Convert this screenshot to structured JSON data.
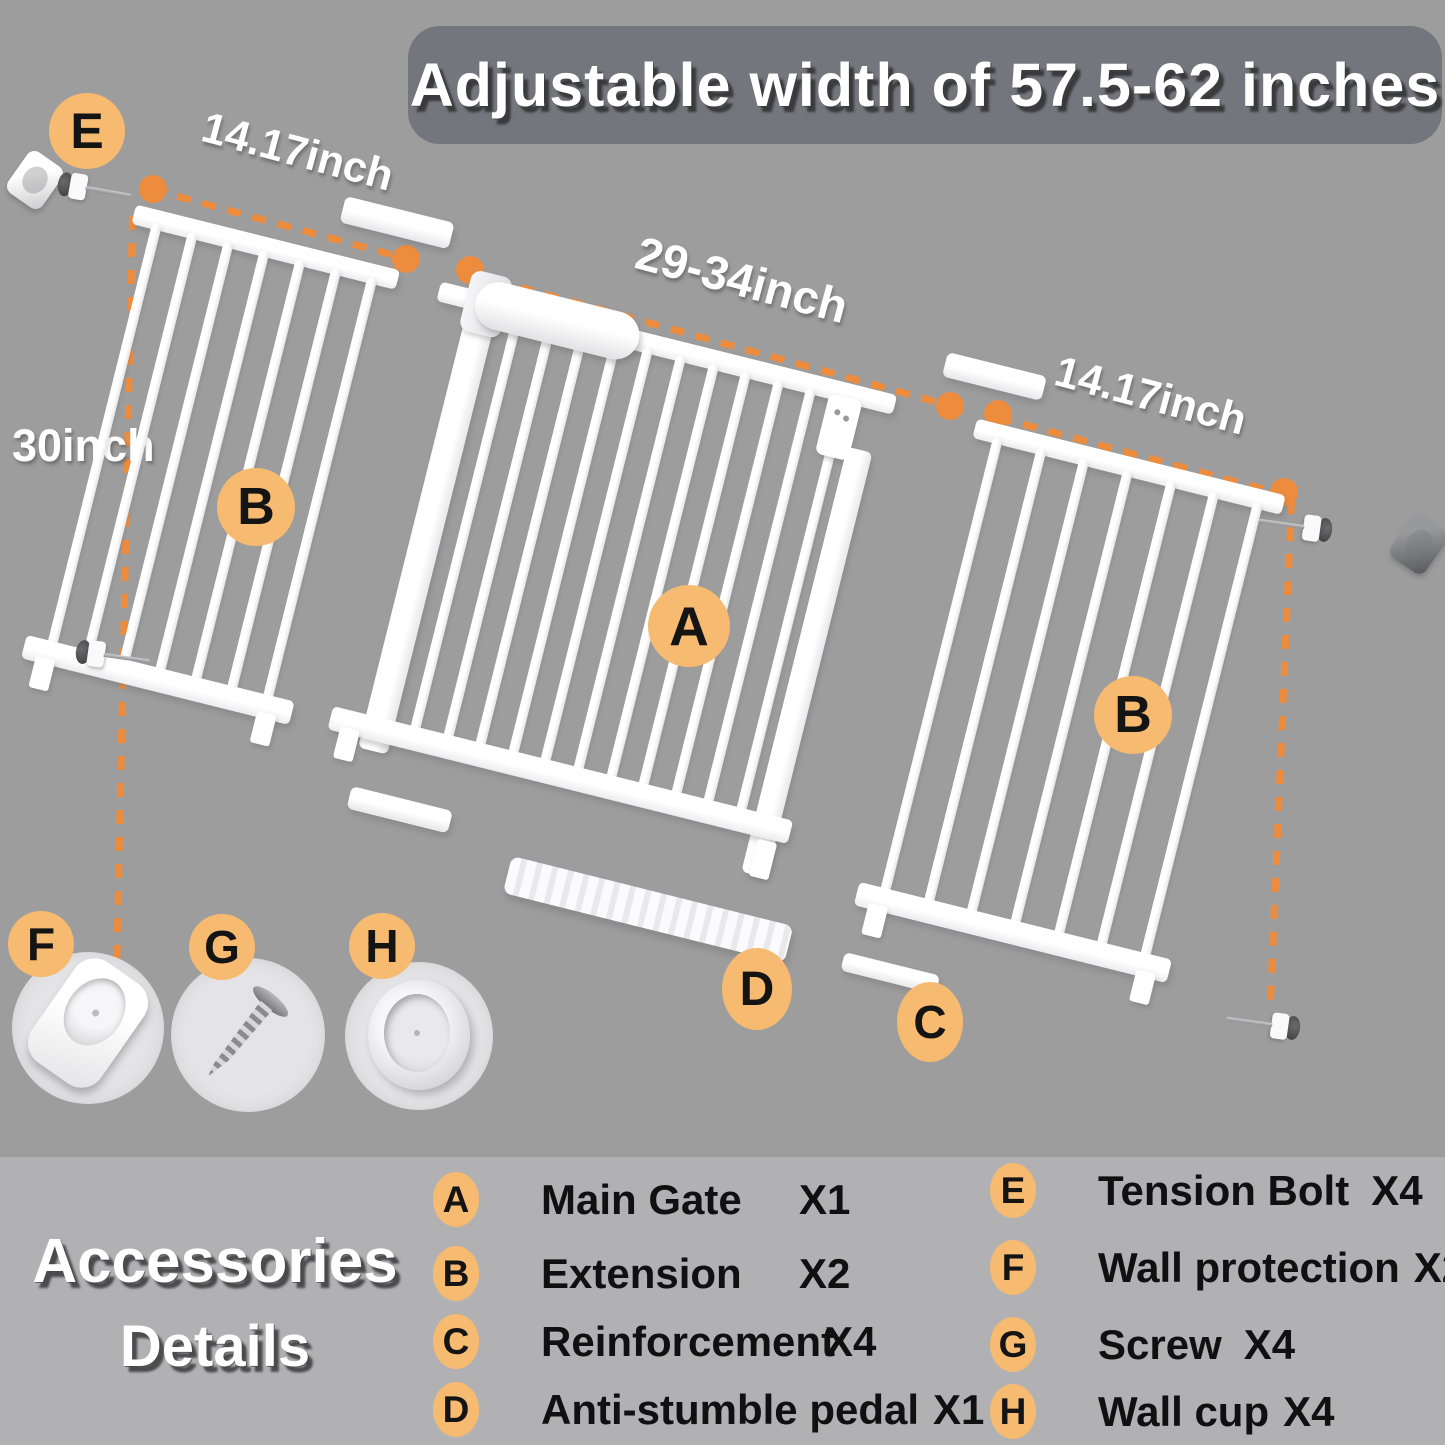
{
  "banner": {
    "title": "Adjustable width of 57.5-62 inches"
  },
  "diagram": {
    "dim_left_width": "14.17inch",
    "dim_main_width": "29-34inch",
    "dim_right_width": "14.17inch",
    "dim_height": "30inch",
    "label_a": "A",
    "label_b_left": "B",
    "label_b_right": "B",
    "label_c": "C",
    "label_d": "D",
    "label_e": "E",
    "label_f": "F",
    "label_g": "G",
    "label_h": "H"
  },
  "legend": {
    "title_line1": "Accessories",
    "title_line2": "Details",
    "left": [
      {
        "badge": "A",
        "label": "Main Gate",
        "count": "X1"
      },
      {
        "badge": "B",
        "label": "Extension",
        "count": "X2"
      },
      {
        "badge": "C",
        "label": "Reinforcement",
        "count": "X4"
      },
      {
        "badge": "D",
        "label": "Anti-stumble pedal",
        "count": "X1"
      }
    ],
    "right": [
      {
        "badge": "E",
        "label": "Tension Bolt",
        "count": "X4"
      },
      {
        "badge": "F",
        "label": "Wall protection",
        "count": "X2"
      },
      {
        "badge": "G",
        "label": "Screw",
        "count": "X4"
      },
      {
        "badge": "H",
        "label": "Wall cup",
        "count": "X4"
      }
    ]
  },
  "colors": {
    "background": "#9d9d9e",
    "legend_background": "#b1b1b3",
    "banner_background": "#73767c",
    "badge_orange": "#f6ba70",
    "dimension_orange": "#ee8c3e",
    "gate_white": "#ffffff"
  }
}
